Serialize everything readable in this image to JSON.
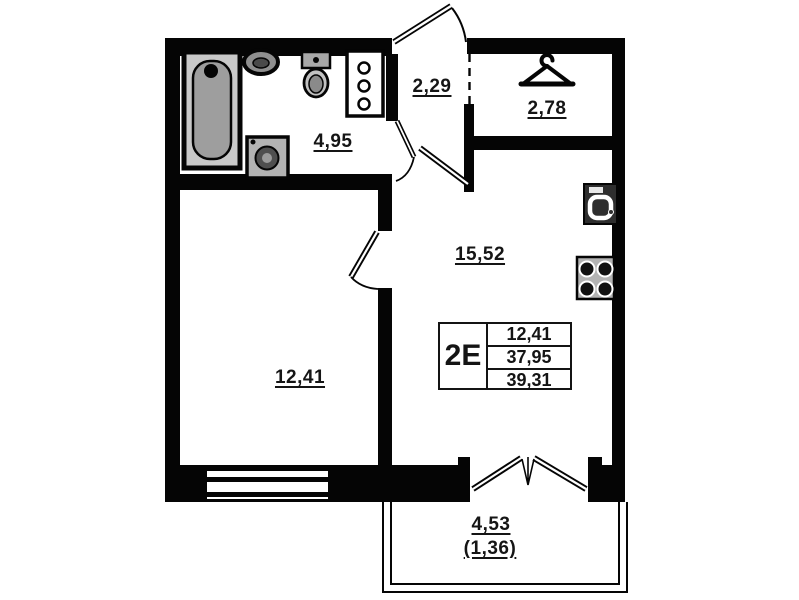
{
  "plan": {
    "rooms": {
      "bathroom": {
        "area": "4,95"
      },
      "hallway": {
        "area": "2,29"
      },
      "wardrobe": {
        "area": "2,78"
      },
      "kitchen_living": {
        "area": "15,52"
      },
      "bedroom": {
        "area": "12,41"
      },
      "balcony": {
        "area": "4,53",
        "area_coefficient": "(1,36)"
      }
    },
    "info_table": {
      "unit_code": "2E",
      "rows": [
        "12,41",
        "37,95",
        "39,31"
      ]
    },
    "icons": {
      "bathtub": "bathtub-icon",
      "bathroom_sink": "sink-icon",
      "toilet": "toilet-icon",
      "utility_shaft": "shaft-icon",
      "washing_machine": "washing-machine-icon",
      "hanger": "hanger-icon",
      "kitchen_sink": "kitchen-sink-icon",
      "stove": "stove-icon"
    },
    "colors": {
      "wall": "#050505",
      "background": "#ffffff",
      "fixture_gray": "#9e9e9e"
    }
  }
}
